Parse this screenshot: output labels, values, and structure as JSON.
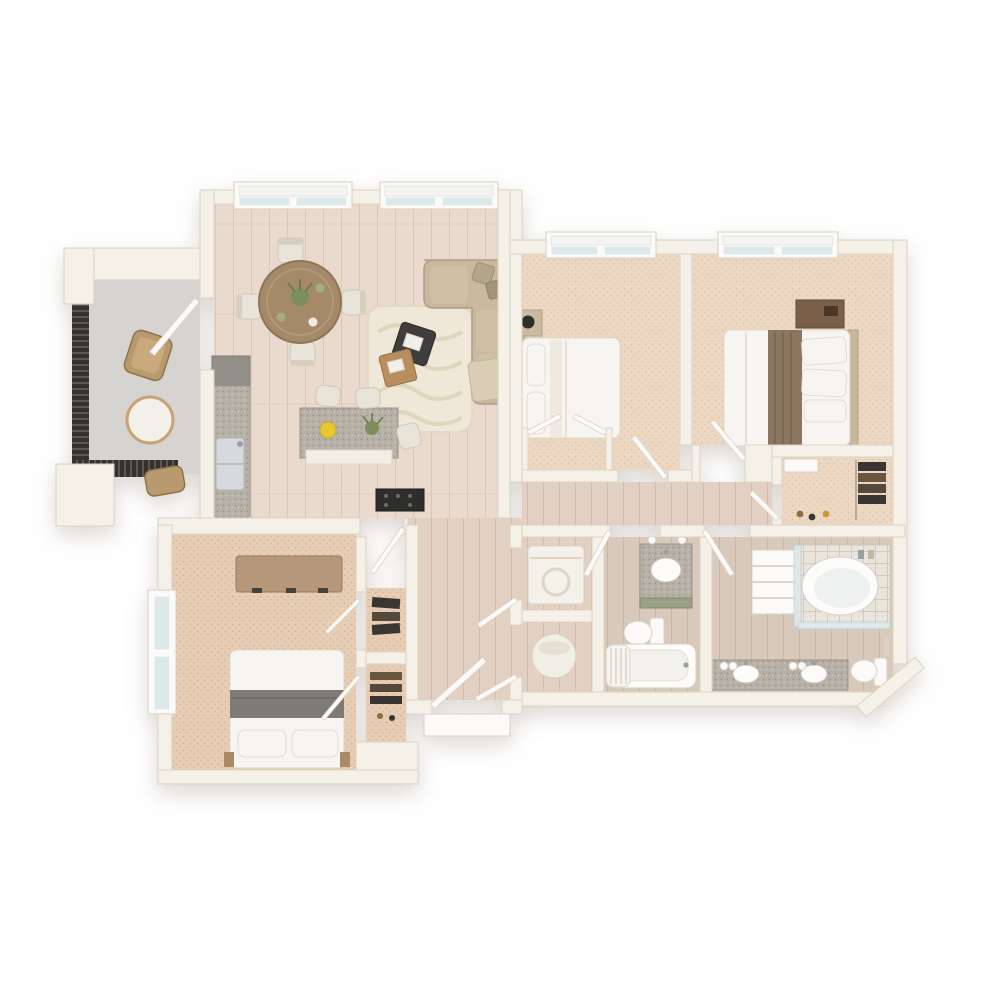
{
  "scene": {
    "type": "3d-floor-plan-render",
    "view": "top-down isometric apartment floor plan",
    "background": "#ffffff",
    "text_labels": "none"
  },
  "palette": {
    "background": "#ffffff",
    "wall": "#f5f0e8",
    "wall_edge": "#dcd3c3",
    "wall_shadow": "#e9e2d5",
    "wood_floor": "#ead9cd",
    "wood_line": "#dcc6b8",
    "hall_wood": "#e2d0c2",
    "bath_floor": "#d9c9ba",
    "carpet": "#ecd8c2",
    "carpet_dot": "#dcc0a5",
    "carpet_dark": "#e6cdb4",
    "balcony_floor": "#d6d4d1",
    "railing": "#35332f",
    "railing_gap": "#6e6b64",
    "granite": "#b6b0a6",
    "granite_dot": "#8f897f",
    "cabinet_white": "#f2eee6",
    "cabinet_sage": "#99a086",
    "sofa": "#c9b89d",
    "sofa_shade": "#b2a287",
    "rug": "#efe7d7",
    "rug_line": "#ddd1b8",
    "wood_table": "#a58a6a",
    "chair": "#e9e4da",
    "bedding_white": "#f7f5f1",
    "runner_brown": "#8d7660",
    "runner_gray": "#7e7a74",
    "headboard": "#c7b79e",
    "dresser": "#b6977a",
    "nightstand_dark": "#7a5f48",
    "fixture_white": "#fbfaf8",
    "glass": "#dce8ea",
    "shade_white": "#f4f4f2",
    "clothes_dark": "#3a3530",
    "clothes_brown": "#6b5640",
    "appliance_dark": "#2f2d2b",
    "accent_lemon": "#e8c832",
    "accent_plant": "#7d8f5c",
    "wicker": "#b99a6f",
    "marble": "#f3efe9"
  },
  "rooms": [
    {
      "id": "balcony",
      "label": "balcony",
      "floor": "concrete deck with dark slat railing"
    },
    {
      "id": "living-dining",
      "label": "living-dining room",
      "floor": "light hardwood",
      "windows": 2
    },
    {
      "id": "kitchen",
      "label": "open kitchen",
      "floor": "light hardwood"
    },
    {
      "id": "hallway",
      "label": "entry hall",
      "floor": "hardwood"
    },
    {
      "id": "bedroom-middle",
      "label": "bedroom (top middle)",
      "floor": "carpet",
      "windows": 1
    },
    {
      "id": "bedroom-primary",
      "label": "primary bedroom (top right)",
      "floor": "carpet",
      "windows": 1
    },
    {
      "id": "bedroom-lower",
      "label": "bedroom (bottom left)",
      "floor": "carpet",
      "windows": 1
    },
    {
      "id": "closet-bedroom-middle",
      "label": "reach-in closet with double doors"
    },
    {
      "id": "walk-in-closet",
      "label": "walk-in closet with hanging clothes"
    },
    {
      "id": "closet-1",
      "label": "hall closet with clothes"
    },
    {
      "id": "closet-2",
      "label": "hall closet with shelves"
    },
    {
      "id": "laundry-closet",
      "label": "laundry closet"
    },
    {
      "id": "water-heater-closet",
      "label": "water heater closet"
    },
    {
      "id": "bathroom-hall",
      "label": "hall bathroom"
    },
    {
      "id": "bathroom-primary",
      "label": "primary bathroom"
    }
  ],
  "furniture": {
    "balcony": [
      "round bistro table",
      "wicker chair",
      "second wicker chair (partial)"
    ],
    "living_dining": [
      "L-sectional sofa",
      "throw pillows",
      "throw blanket",
      "wavy cream area rug",
      "dark nesting coffee table with books",
      "wood nesting coffee table",
      "round wood dining table",
      "4 white dining chairs",
      "centerpiece plant",
      "place settings"
    ],
    "kitchen": [
      "granite counter with double stainless sink",
      "dark backsplash panel",
      "granite island with white cabinets",
      "3 bar stools",
      "dark range",
      "lemon plate",
      "small plant"
    ],
    "bedroom_middle": [
      "bed with white bedding",
      "pillows",
      "nightstand with black lamp",
      "double-door closet"
    ],
    "bedroom_primary": [
      "bed with white duvet and brown runner",
      "4 pillows",
      "tan headboard",
      "dark nightstand"
    ],
    "bedroom_lower": [
      "bed with white pillows and gray runner",
      "tan dresser with dark handles"
    ],
    "laundry_closet": [
      "washer"
    ],
    "water_heater_closet": [
      "water heater cylinder"
    ],
    "bathroom_hall": [
      "granite vanity with sage cabinet and sink",
      "toilet",
      "bathtub with shower curtain"
    ],
    "bathroom_primary": [
      "glass-enclosed corner tub shower",
      "linen shelf tower",
      "long granite double-sink vanity",
      "globe vanity lights",
      "toilet",
      "towel bar"
    ]
  },
  "doors": [
    "balcony door",
    "front entry door with exterior frame",
    "bedroom-middle door",
    "primary-bedroom door",
    "lower-bedroom door",
    "hall-bathroom door",
    "primary-bathroom door",
    "walk-in-closet door",
    "laundry door",
    "water-heater-closet door",
    "closet double doors",
    "two hall closet doors"
  ],
  "windows": {
    "living_room": 2,
    "bedroom_middle": 1,
    "bedroom_primary": 1,
    "bedroom_lower": 1
  }
}
